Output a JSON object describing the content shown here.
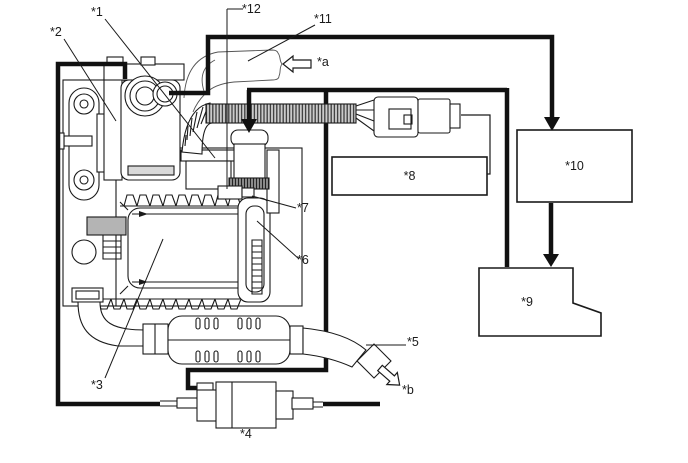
{
  "canvas": {
    "background": "#ffffff",
    "line_color": "#1a1a1a",
    "thick_line_color": "#111111",
    "gray_fill": "#b4b4b4",
    "hose_fill": "#cbcbcb",
    "band_fill": "#8a8a8a"
  },
  "labels": {
    "n1": "*1",
    "n2": "*2",
    "n3": "*3",
    "n4": "*4",
    "n5": "*5",
    "n6": "*6",
    "n7": "*7",
    "n8": "*8",
    "n9": "*9",
    "n10": "*10",
    "n11": "*11",
    "n12": "*12",
    "a": "*a",
    "b": "*b"
  },
  "icons": {
    "airflow-in-arrow": "outline-arrow-left",
    "exhaust-out-arrow": "outline-arrow-down-right",
    "signal-arrowhead": "solid-triangle-down"
  }
}
